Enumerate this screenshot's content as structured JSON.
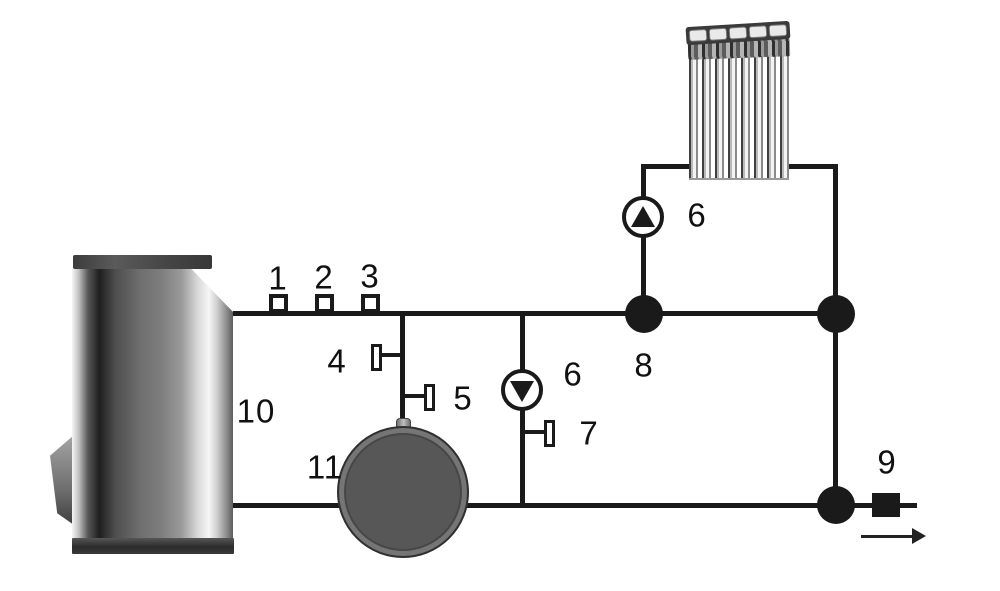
{
  "diagram": {
    "kind": "heating-system-piping-schematic",
    "labels": [
      {
        "id": "tapping-1",
        "text": "1"
      },
      {
        "id": "tapping-2",
        "text": "2"
      },
      {
        "id": "tapping-3",
        "text": "3"
      },
      {
        "id": "sensor-4",
        "text": "4"
      },
      {
        "id": "sensor-5",
        "text": "5"
      },
      {
        "id": "pump-radiator",
        "text": "6"
      },
      {
        "id": "pump-boiler",
        "text": "6"
      },
      {
        "id": "sensor-7",
        "text": "7"
      },
      {
        "id": "junction-8",
        "text": "8"
      },
      {
        "id": "outlet-9",
        "text": "9"
      },
      {
        "id": "boiler-10",
        "text": "10"
      },
      {
        "id": "expansion-tank-11",
        "text": "11"
      }
    ],
    "colors": {
      "line": "#1a1a1a",
      "tank_fill": "#575757",
      "pump_fill": "#ffffff"
    }
  }
}
